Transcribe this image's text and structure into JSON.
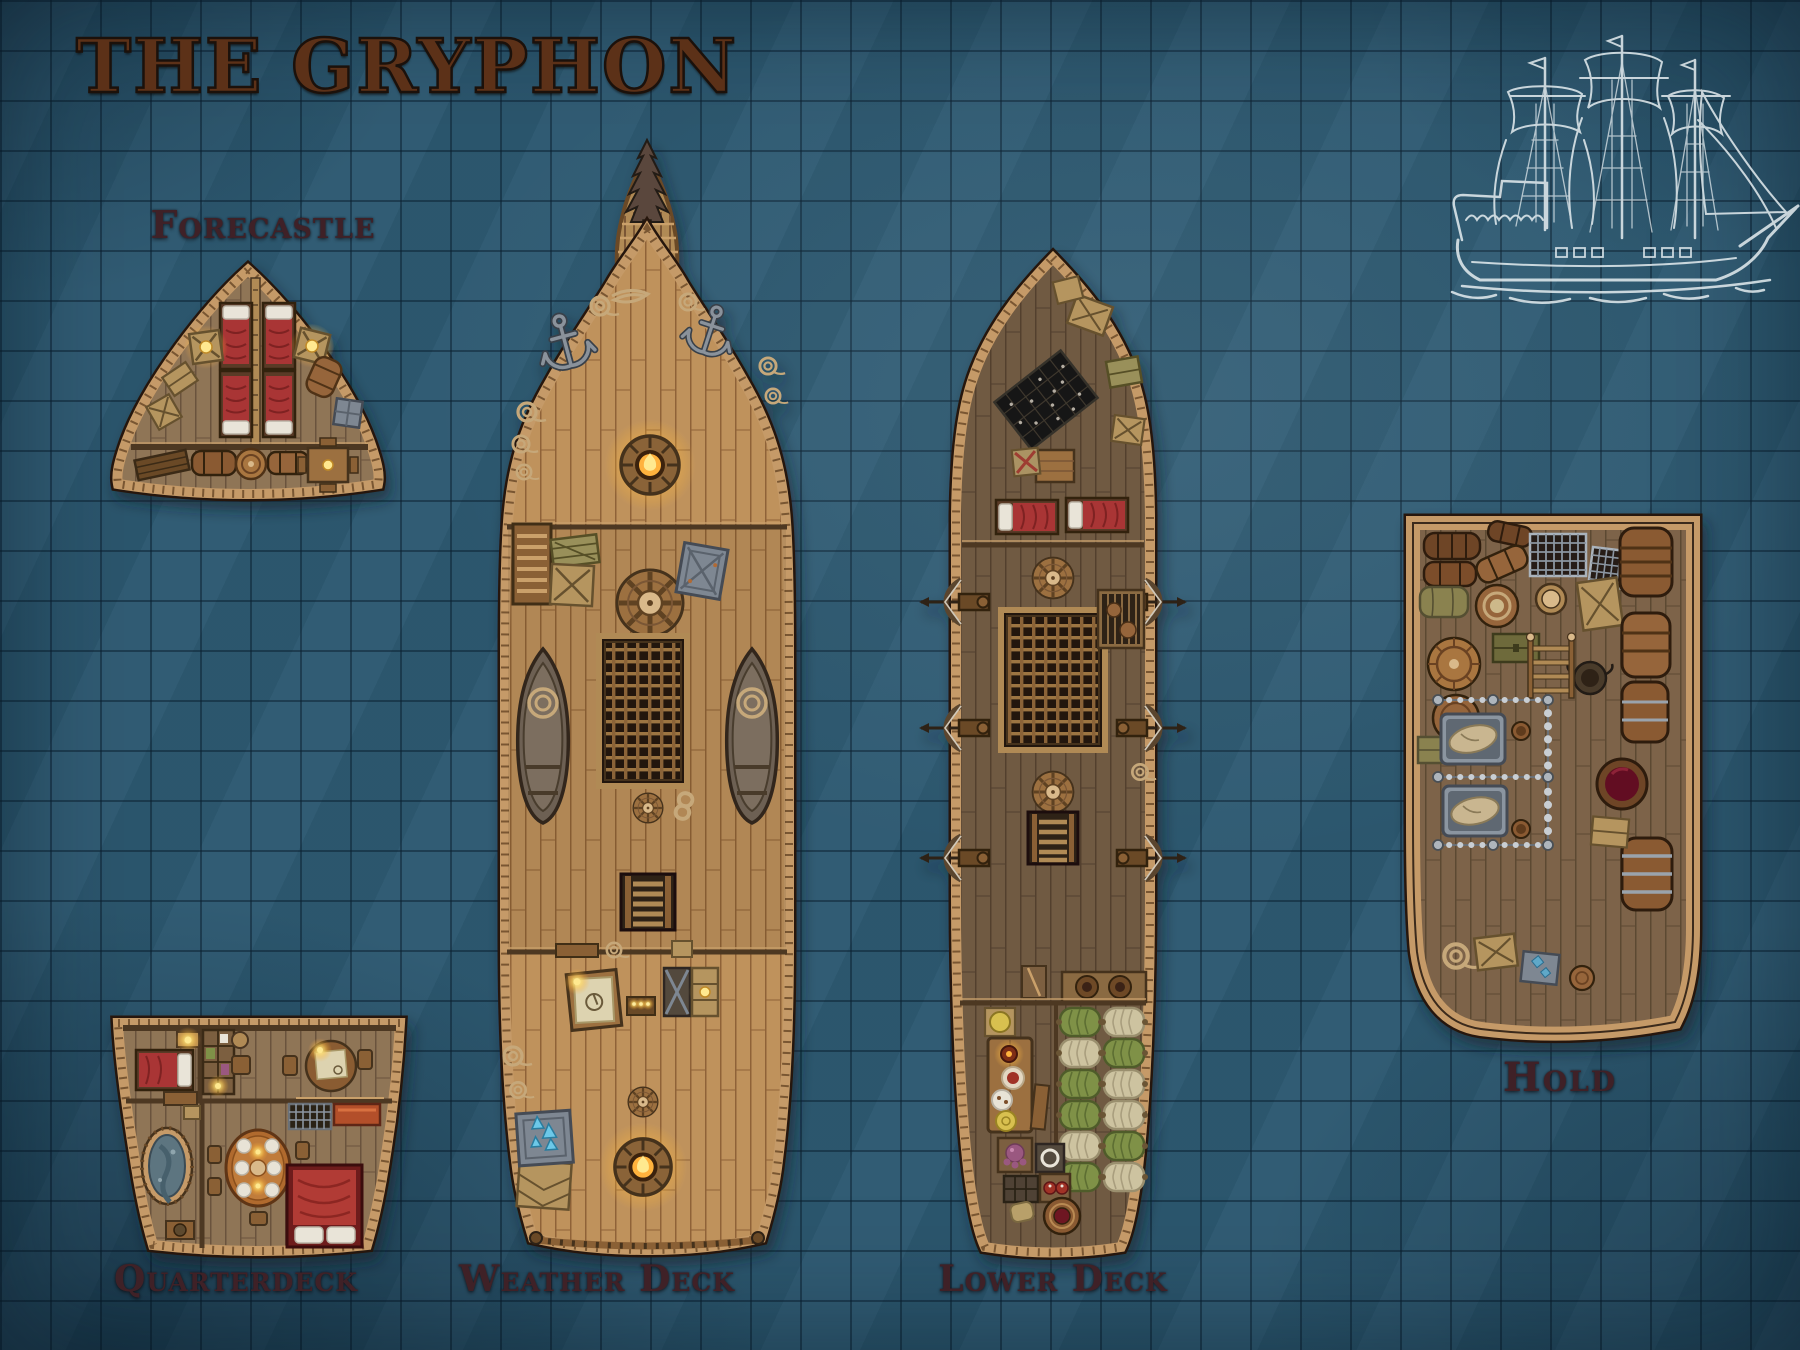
{
  "title": "THE GRYPHON",
  "decks": [
    {
      "id": "forecastle",
      "label": "Forecastle"
    },
    {
      "id": "quarterdeck",
      "label": "Quarterdeck"
    },
    {
      "id": "weather-deck",
      "label": "Weather Deck"
    },
    {
      "id": "lower-deck",
      "label": "Lower Deck"
    },
    {
      "id": "hold",
      "label": "Hold"
    }
  ],
  "grid": {
    "cell_px": 50,
    "columns": 36,
    "rows": 27
  },
  "sketch": {
    "name": "three-masted-ship-blueprint-sketch"
  },
  "palette": {
    "sea": "#2d5971",
    "grid_line": "#16384d",
    "hull_trim": "#c59a67",
    "deck_light": "#bf925c",
    "deck_mid": "#8f7457",
    "deck_dark": "#705a43",
    "hold_wood": "#7d6449",
    "bed_red": "#a93434",
    "hammock_green": "#7f9147",
    "hammock_tan": "#cdc3a0",
    "label_color": "#3f2127",
    "title_color": "#5c3118",
    "sketch_white": "#e5edf0",
    "glow_yellow": "#ffd964"
  }
}
